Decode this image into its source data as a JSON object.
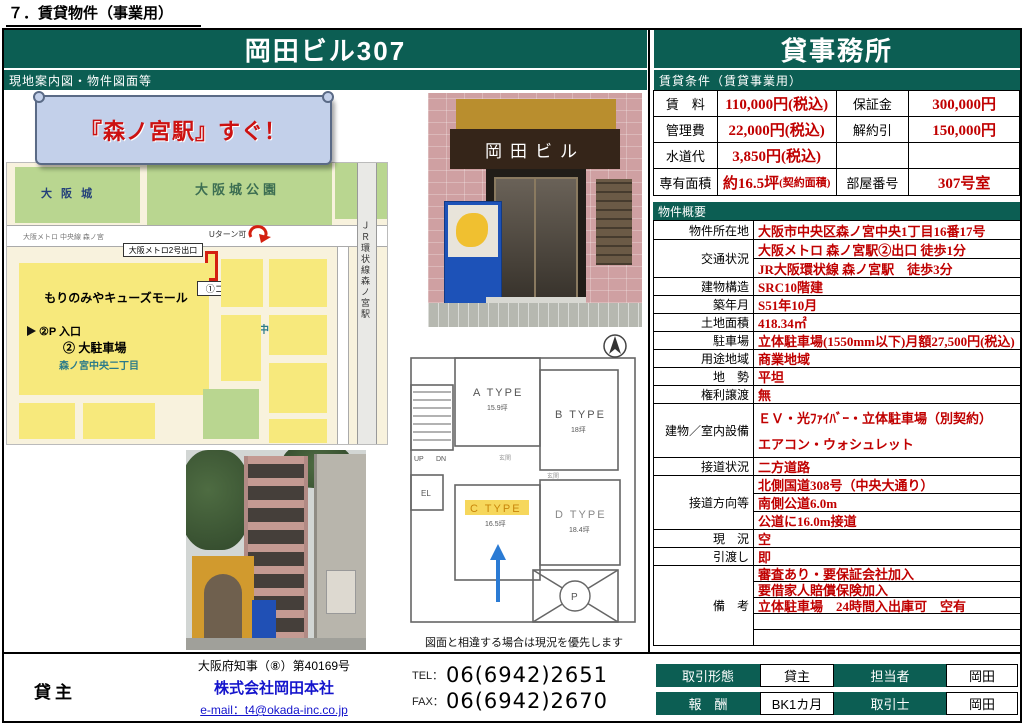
{
  "page_title": "７．賃貸物件（事業用）",
  "header": {
    "building": "岡田ビル307",
    "category": "貸事務所"
  },
  "left": {
    "section_title": "現地案内図・物件図面等",
    "banner_text": "『森ノ宮駅』すぐ！",
    "map": {
      "castle": "大 阪 城",
      "park": "大阪城公園",
      "metro_line": "大阪メトロ 中央線 森ノ宮",
      "u_turn": "Uターン可",
      "exit_callout": "大阪メトロ2号出口",
      "mall": "もりのみやキューズモール",
      "big_parking": "② 大駐車場",
      "chome2": "森ノ宮中央二丁目",
      "chome1": "森ノ宮中央一丁目",
      "coin_parking": "①コイン P",
      "p_entrance": "②P 入口",
      "jr_station": "ＪＲ環状線森ノ宮駅"
    },
    "entrance_photo": {
      "sign": "岡田ビル"
    },
    "floorplan": {
      "rooms": [
        {
          "name": "A TYPE",
          "size": "15.9坪"
        },
        {
          "name": "B TYPE",
          "size": "18坪"
        },
        {
          "name": "C TYPE",
          "size": "16.5坪"
        },
        {
          "name": "D TYPE",
          "size": "18.4坪"
        }
      ],
      "up": "UP",
      "dn": "DN",
      "el": "EL",
      "parking": "P",
      "genkan": "玄関",
      "caption": "図面と相違する場合は現況を優先します"
    }
  },
  "conditions": {
    "section_title": "賃貸条件（賃貸事業用）",
    "rows": [
      {
        "l1": "賃　料",
        "v1": "110,000円(税込)",
        "s1": "",
        "l2": "保証金",
        "v2": "300,000円"
      },
      {
        "l1": "管理費",
        "v1": "22,000円(税込)",
        "s1": "",
        "l2": "解約引",
        "v2": "150,000円"
      },
      {
        "l1": "水道代",
        "v1": "3,850円(税込)",
        "s1": "",
        "l2": "",
        "v2": ""
      },
      {
        "l1": "専有面積",
        "v1": "約16.5坪",
        "s1": "(契約面積)",
        "l2": "部屋番号",
        "v2": "307号室"
      }
    ]
  },
  "overview": {
    "section_title": "物件概要",
    "rows": [
      {
        "label": "物件所在地",
        "values": [
          "大阪市中央区森ノ宮中央1丁目16番17号"
        ]
      },
      {
        "label": "交通状況",
        "values": [
          "大阪メトロ 森ノ宮駅②出口 徒歩1分",
          "JR大阪環状線 森ノ宮駅　徒歩3分"
        ]
      },
      {
        "label": "建物構造",
        "values": [
          "SRC10階建"
        ]
      },
      {
        "label": "築年月",
        "values": [
          "S51年10月"
        ]
      },
      {
        "label": "土地面積",
        "values": [
          "418.34㎡"
        ]
      },
      {
        "label": "駐車場",
        "values": [
          "立体駐車場(1550mm以下)月額27,500円(税込)"
        ]
      },
      {
        "label": "用途地域",
        "values": [
          "商業地域"
        ]
      },
      {
        "label": "地　勢",
        "values": [
          "平坦"
        ]
      },
      {
        "label": "権利譲渡",
        "values": [
          "無"
        ]
      },
      {
        "label": "建物／室内設備",
        "values": [
          "ＥＶ・光ﾌｧｲﾊﾞｰ・立体駐車場（別契約）",
          "エアコン・ウォシュレット"
        ]
      },
      {
        "label": "接道状況",
        "values": [
          "二方道路"
        ]
      },
      {
        "label": "接道方向等",
        "values": [
          "北側国道308号（中央大通り）",
          "南側公道6.0m",
          "公道に16.0m接道"
        ]
      },
      {
        "label": "現　況",
        "values": [
          "空"
        ]
      },
      {
        "label": "引渡し",
        "values": [
          "即"
        ]
      },
      {
        "label": "備　考",
        "values": [
          "審査あり・要保証会社加入",
          "要借家人賠償保険加入",
          "立体駐車場　24時間入出庫可　空有",
          "",
          ""
        ]
      }
    ]
  },
  "footer": {
    "lessor_label": "貸主",
    "license": "大阪府知事（⑧）第40169号",
    "company": "株式会社岡田本社",
    "email": "e-mail：t4@okada-inc.co.jp",
    "tel_label": "TEL：",
    "tel": "06(6942)2651",
    "fax_label": "FAX：",
    "fax": "06(6942)2670",
    "deal": {
      "r1l1": "取引形態",
      "r1v1": "貸主",
      "r1l2": "担当者",
      "r1v2": "岡田",
      "r2l1": "報　酬",
      "r2v1": "BK1カ月",
      "r2l2": "取引士",
      "r2v2": "岡田"
    }
  },
  "colors": {
    "accent": "#0c5e53",
    "value_red": "#c00000",
    "link_blue": "#1414cc"
  }
}
